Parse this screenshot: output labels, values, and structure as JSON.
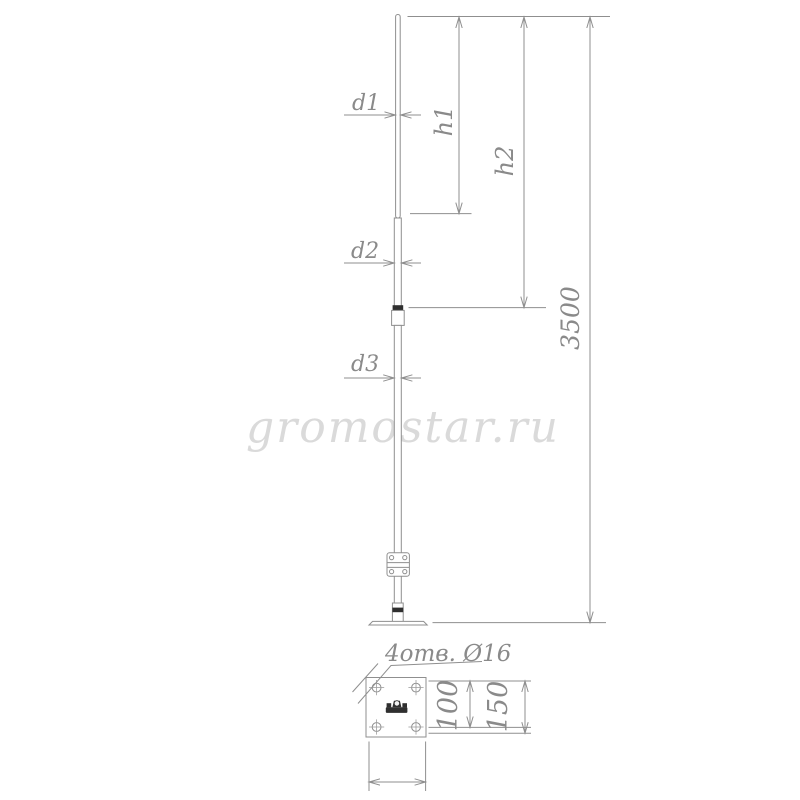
{
  "watermark": "gromostar.ru",
  "front_view": {
    "labels": {
      "d1": "d1",
      "d2": "d2",
      "d3": "d3",
      "h1": "h1",
      "h2": "h2",
      "total_height": "3500"
    }
  },
  "detail_view": {
    "holes_note": "4отв. Ø16",
    "hole_spacing": "100",
    "plate_size": "150"
  },
  "colors": {
    "line": "#8f8f8f",
    "text": "#8a8a8a",
    "dark_fill": "#2f2f2f",
    "watermark": "#dadada",
    "background": "#ffffff"
  }
}
